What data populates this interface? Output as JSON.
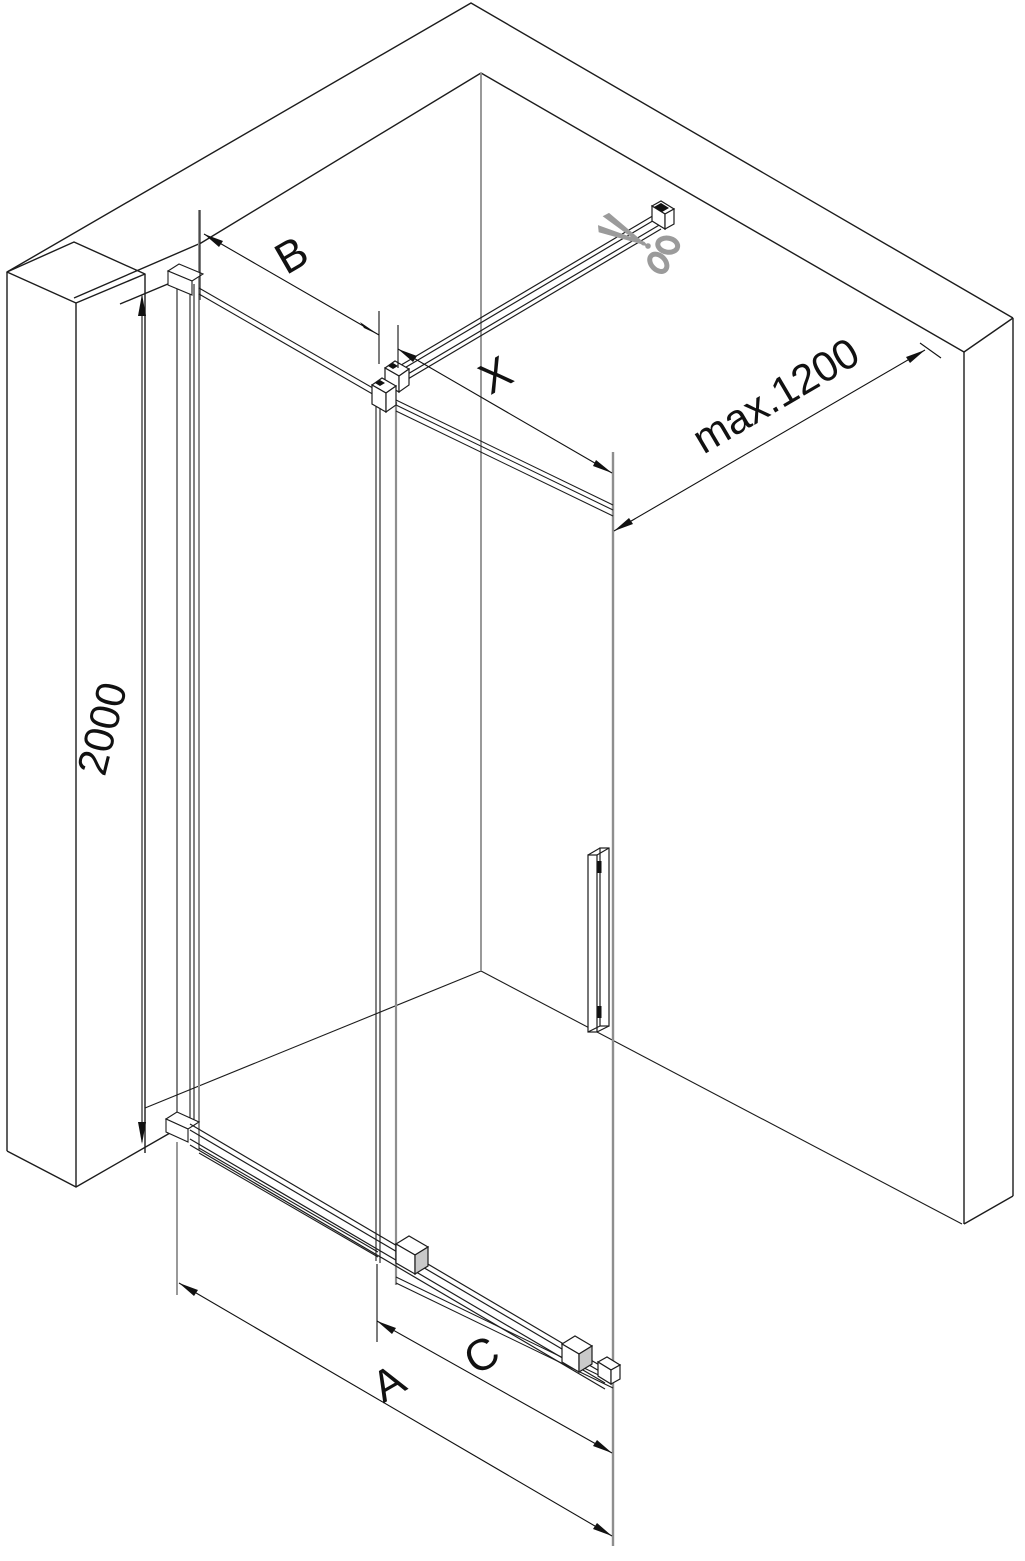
{
  "diagram": {
    "labels": {
      "height": "2000",
      "panel_width": "B",
      "door_width": "X",
      "rail_max": "max.1200",
      "total_width": "A",
      "opening_width": "C"
    },
    "icons": {
      "scissors": "✂"
    },
    "colors": {
      "line": "#1c1c1c",
      "dim": "#111111",
      "glass_edge": "#8e8e8e",
      "scissors": "#9b9b9b",
      "detail": "#111111",
      "shade": "#c9c9c9",
      "background": "#ffffff"
    }
  }
}
